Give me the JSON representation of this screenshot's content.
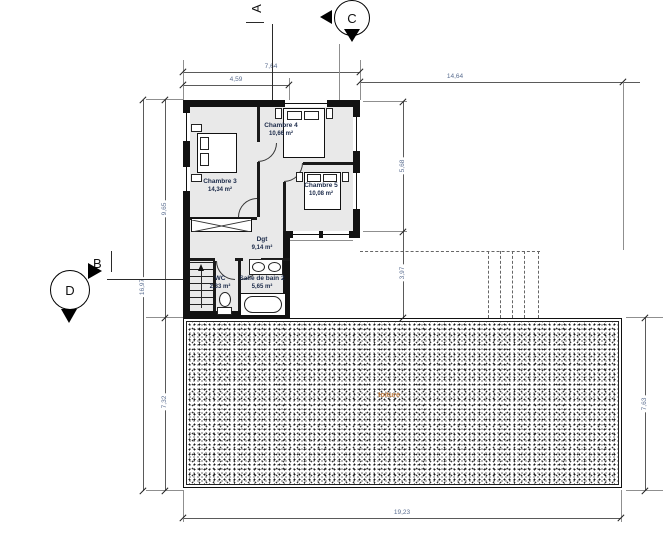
{
  "markers": {
    "a": "A",
    "b": "B",
    "c": "C",
    "d": "D"
  },
  "rooms": [
    {
      "name": "Chambre 3",
      "area": "14,34 m²"
    },
    {
      "name": "Chambre 4",
      "area": "10,66 m²"
    },
    {
      "name": "Chambre 5",
      "area": "10,08 m²"
    },
    {
      "name": "Dgt",
      "area": "9,14 m²"
    },
    {
      "name": "WC",
      "area": "2,33 m²"
    },
    {
      "name": "Salle de bain 2",
      "area": "5,65 m²"
    }
  ],
  "annotations": {
    "roof_label": "toiture"
  },
  "dimensions": {
    "top_width_total": "7,64",
    "top_width_partial": "4,59",
    "top_right_width": "14,64",
    "left_height_total": "16,97",
    "left_height_upper": "9,65",
    "left_height_lower": "7,32",
    "right_inner_upper": "5,68",
    "right_inner_lower": "3,97",
    "right_outer_height": "7,63",
    "bottom_width_total": "19,23"
  },
  "colors": {
    "wall": "#121212",
    "room_fill": "#e9e9e9",
    "dimension_text": "#5c6f91",
    "room_label": "#1c2b4a",
    "roof_label": "#c07a3d"
  }
}
